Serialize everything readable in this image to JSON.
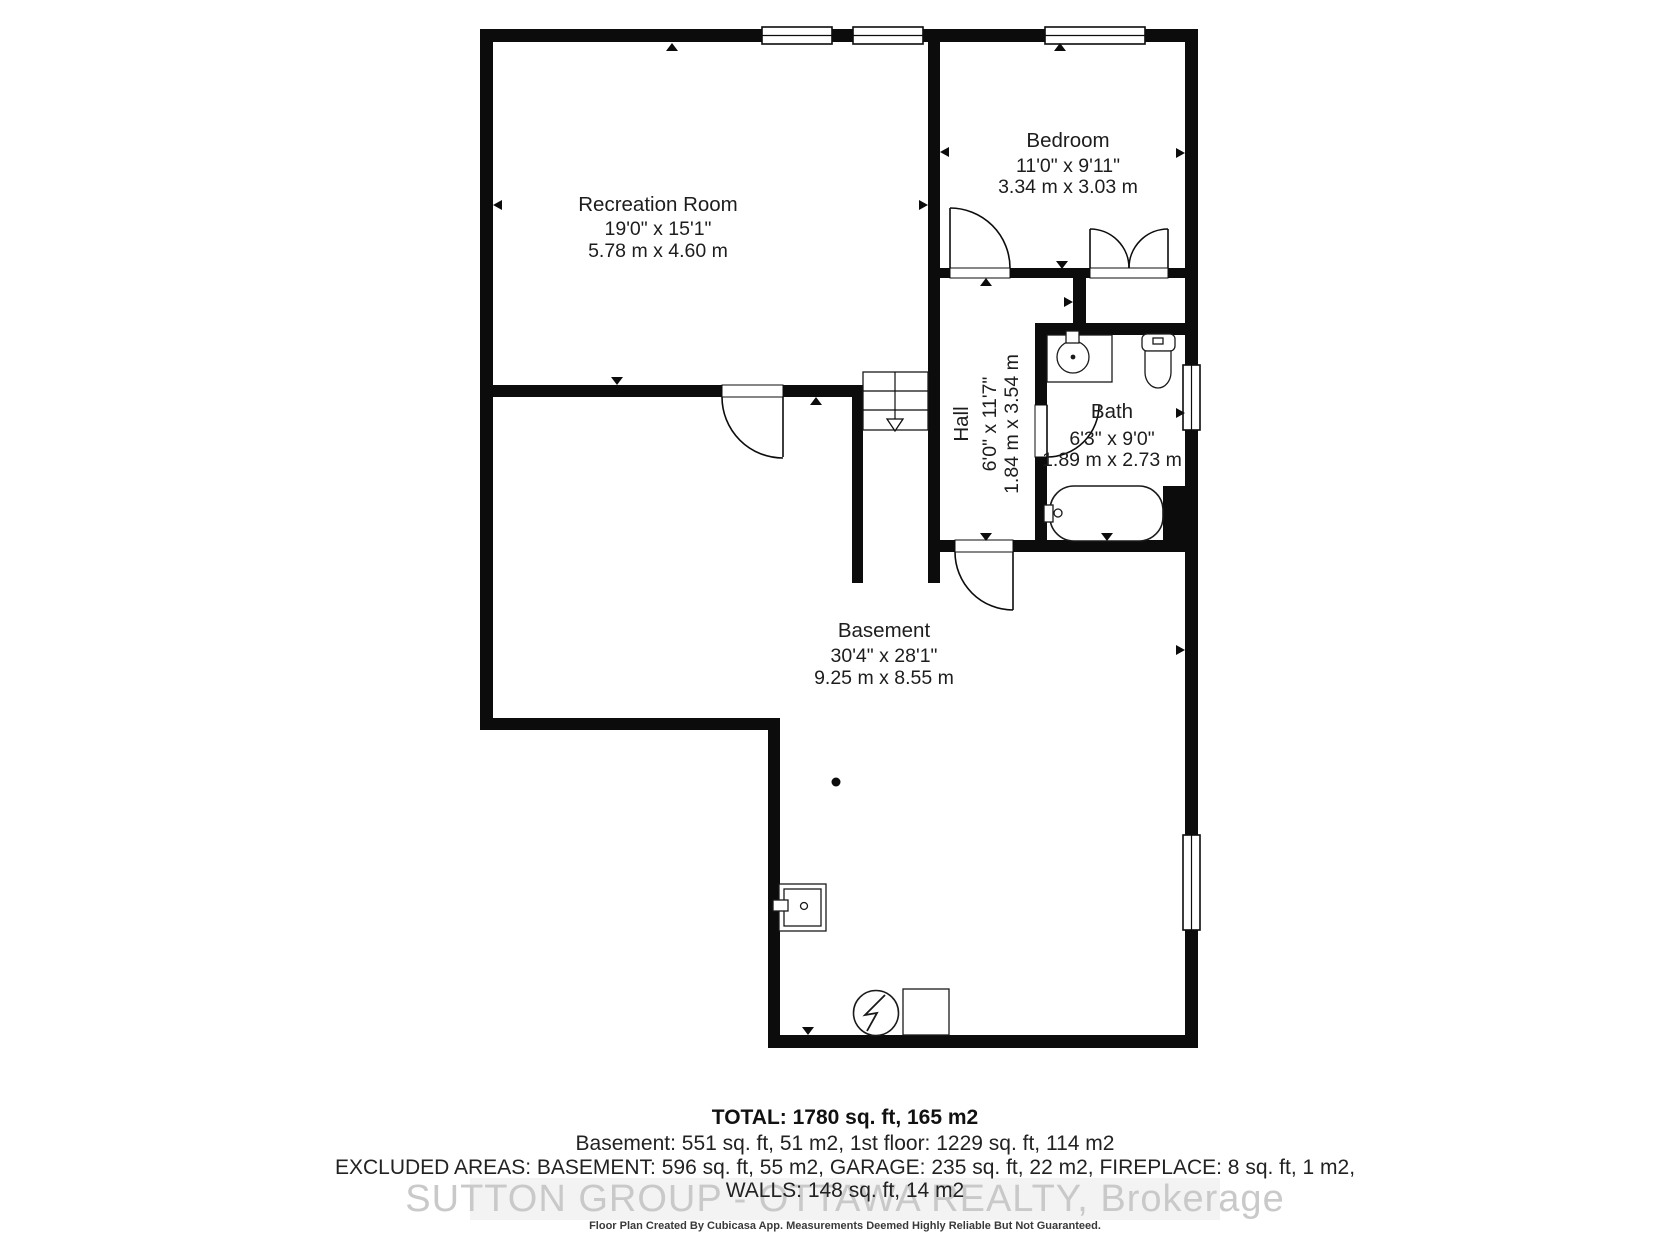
{
  "rooms": {
    "recreation": {
      "name": "Recreation Room",
      "dim_ft": "19'0\" x 15'1\"",
      "dim_m": "5.78 m x 4.60 m"
    },
    "bedroom": {
      "name": "Bedroom",
      "dim_ft": "11'0\" x 9'11\"",
      "dim_m": "3.34 m x 3.03 m"
    },
    "hall": {
      "name": "Hall",
      "dim_ft": "6'0\" x 11'7\"",
      "dim_m": "1.84 m x 3.54 m"
    },
    "bath": {
      "name": "Bath",
      "dim_ft": "6'3\" x 9'0\"",
      "dim_m": "1.89 m x 2.73 m"
    },
    "basement": {
      "name": "Basement",
      "dim_ft": "30'4\" x 28'1\"",
      "dim_m": "9.25 m x 8.55 m"
    }
  },
  "summary": {
    "total": "TOTAL: 1780 sq. ft, 165 m2",
    "floors": "Basement: 551 sq. ft, 51 m2, 1st floor: 1229 sq. ft, 114 m2",
    "excluded": "EXCLUDED AREAS: BASEMENT: 596 sq. ft, 55 m2, GARAGE: 235 sq. ft, 22 m2, FIREPLACE: 8 sq. ft, 1 m2,",
    "walls": "WALLS: 148 sq. ft, 14 m2"
  },
  "watermark": "SUTTON GROUP - OTTAWA REALTY, Brokerage",
  "disclaimer": "Floor Plan Created By Cubicasa App. Measurements Deemed Highly Reliable But Not Guaranteed.",
  "colors": {
    "wall": "#0c0c0c",
    "watermark": "#c9c9c9"
  },
  "fixtures": [
    "stairs-down",
    "bathtub",
    "toilet",
    "sink",
    "laundry-tub",
    "furnace",
    "water-heater",
    "support-column"
  ]
}
